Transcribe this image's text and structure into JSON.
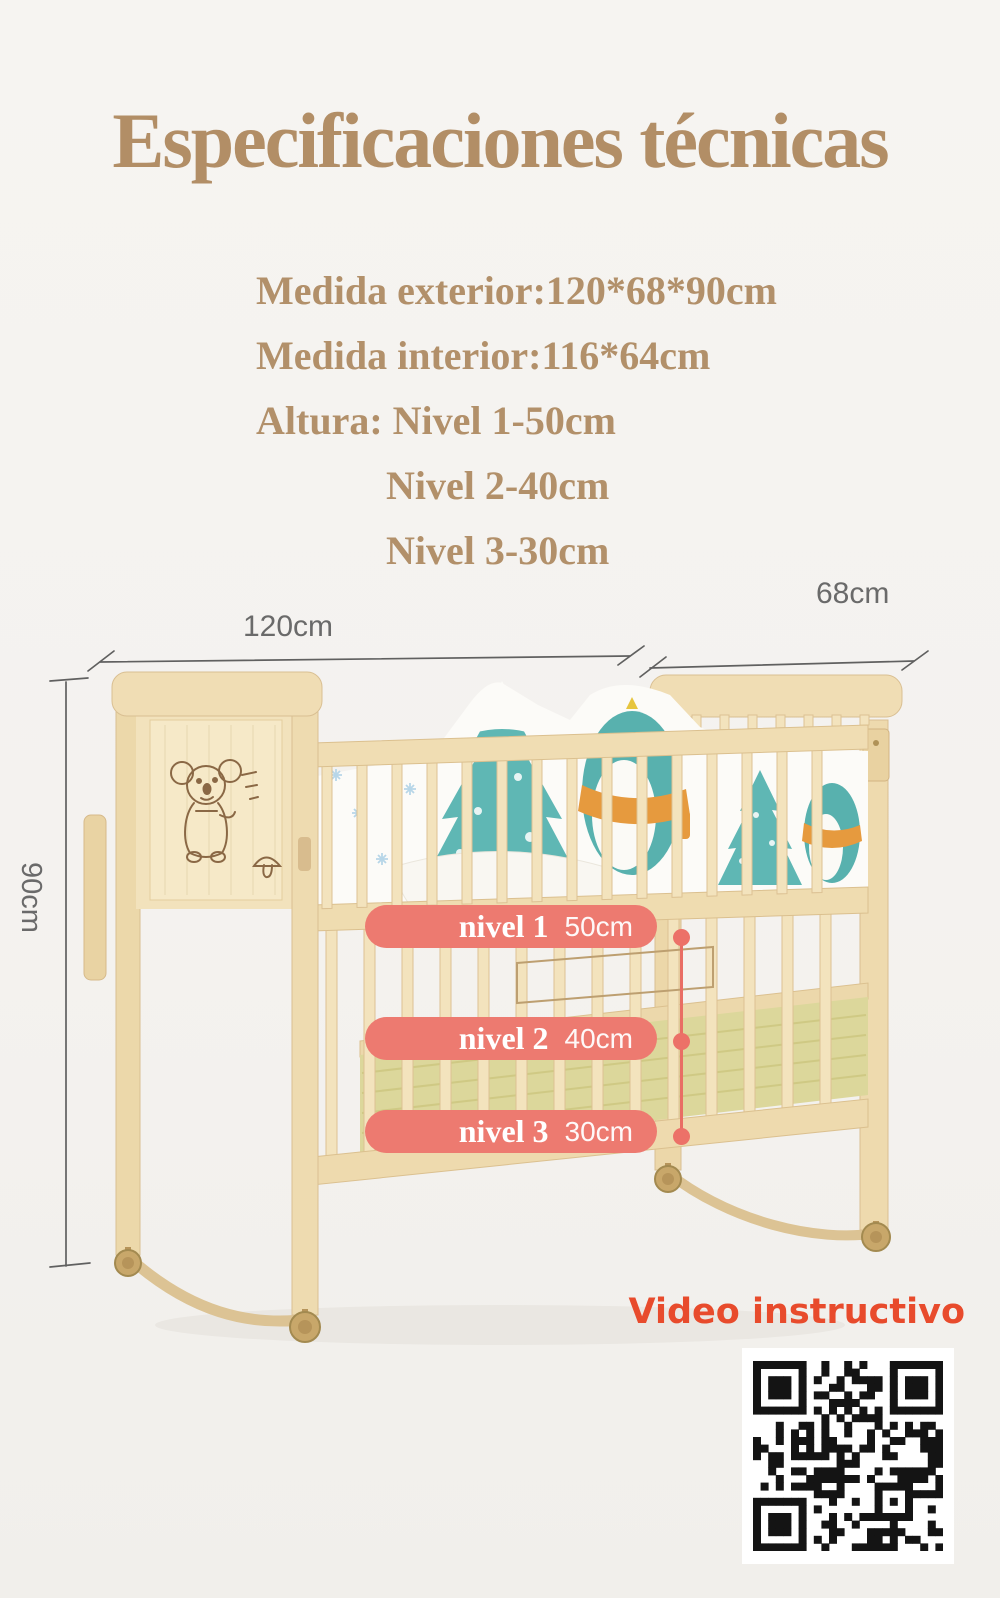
{
  "title": "Especificaciones técnicas",
  "specs": {
    "lines": [
      {
        "text": "Medida exterior:120*68*90cm"
      },
      {
        "text": "Medida interior:116*64cm"
      },
      {
        "text": "Altura: Nivel 1-50cm"
      },
      {
        "text": "Nivel 2-40cm"
      },
      {
        "text": "Nivel 3-30cm"
      }
    ]
  },
  "dimensions": {
    "width_label": "120cm",
    "depth_label": "68cm",
    "height_label": "90cm"
  },
  "levels": [
    {
      "name": "nivel 1",
      "value": "50cm"
    },
    {
      "name": "nivel 2",
      "value": "40cm"
    },
    {
      "name": "nivel 3",
      "value": "30cm"
    }
  ],
  "video": {
    "label": "Video instructivo"
  },
  "qr": {
    "name": "qr-code"
  },
  "colors": {
    "heading_text": "#b2906a",
    "level_pill": "#ed7a70",
    "video_label": "#e84b2c",
    "dimension_lines": "#606060",
    "crib_wood": "#f0ddb4",
    "bedding_teal": "#5fb7b4",
    "scarf_orange": "#e69a3e",
    "mat_green": "#dcd79b"
  }
}
